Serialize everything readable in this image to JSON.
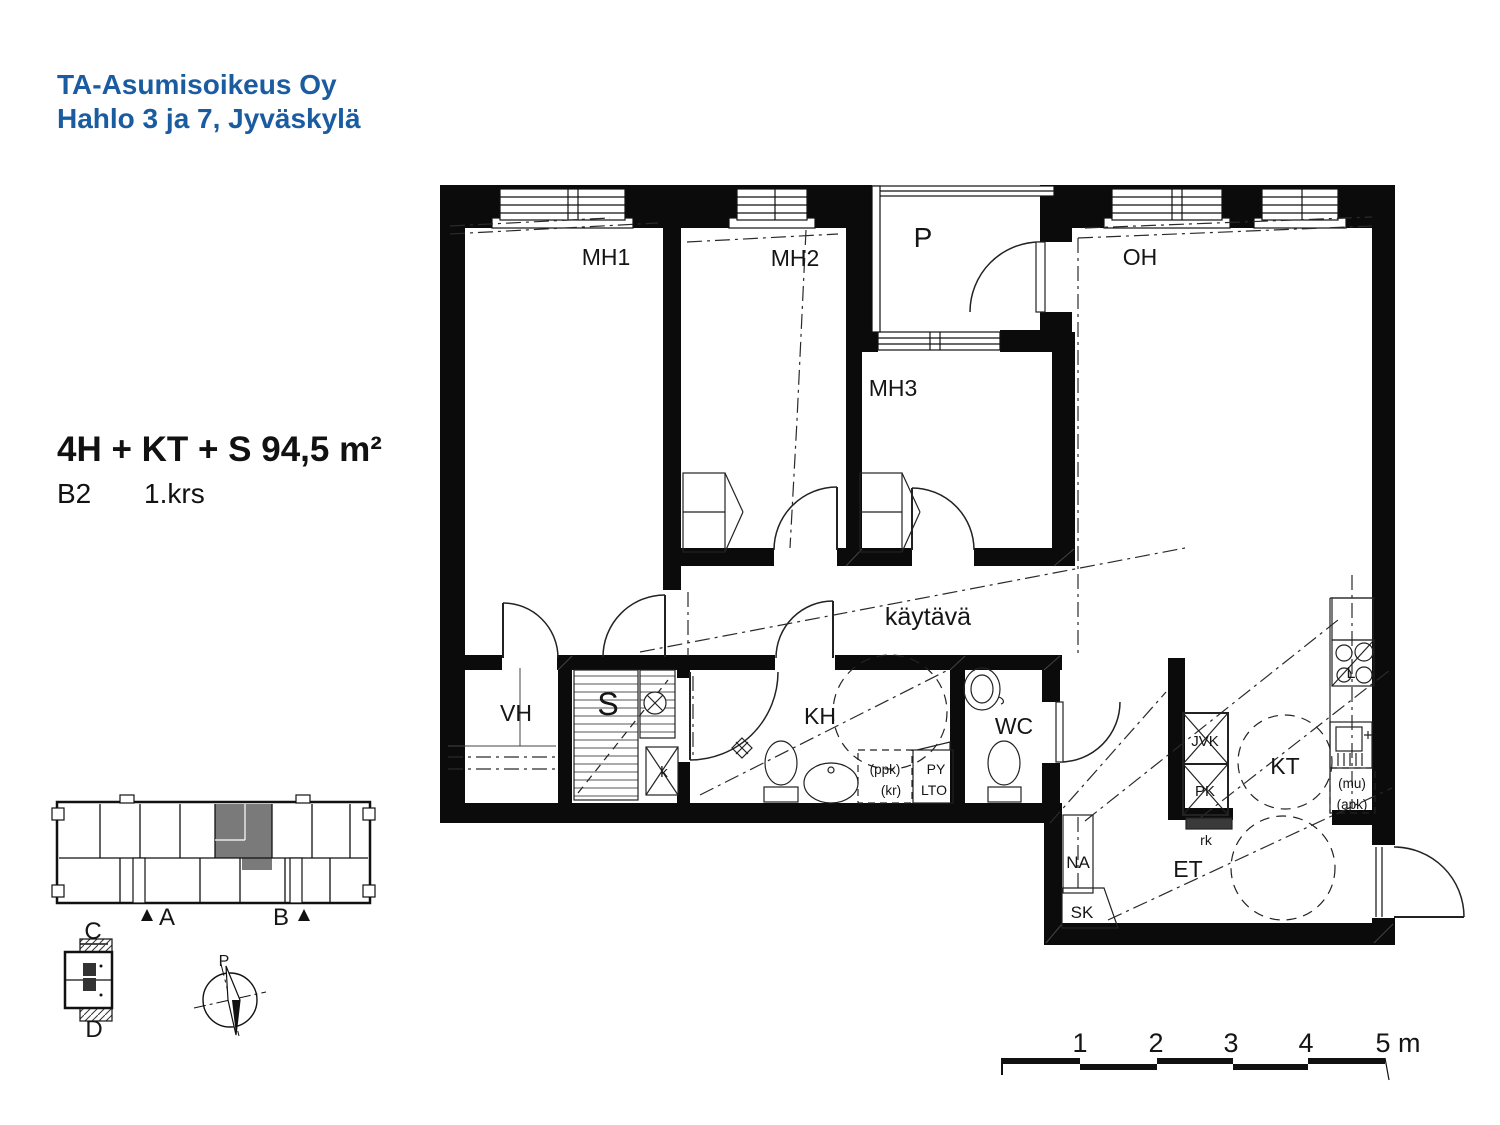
{
  "header": {
    "company": "TA-Asumisoikeus Oy",
    "project": "Hahlo 3 ja 7, Jyväskylä"
  },
  "apartment": {
    "type_area": "4H + KT + S 94,5 m²",
    "unit": "B2",
    "floor": "1.krs"
  },
  "rooms": {
    "mh1": "MH1",
    "mh2": "MH2",
    "mh3": "MH3",
    "oh": "OH",
    "p": "P",
    "kaytava": "käytävä",
    "vh": "VH",
    "s": "S",
    "kh": "KH",
    "wc": "WC",
    "kt": "KT",
    "et": "ET"
  },
  "fixtures": {
    "na": "NA",
    "sk": "SK",
    "jvk": "JVK",
    "pk": "PK",
    "rk": "rk",
    "k": "k",
    "l": "L",
    "ppk": "(ppk)",
    "kr": "(kr)",
    "py": "PY",
    "lto": "LTO",
    "mu": "(mu)",
    "apk": "(apk)"
  },
  "locator": {
    "stair_a": "A",
    "stair_b": "B",
    "stair_c": "C",
    "stair_d": "D",
    "compass_north": "P"
  },
  "scalebar": {
    "m1": "1",
    "m2": "2",
    "m3": "3",
    "m4": "4",
    "m5": "5 m"
  },
  "colors": {
    "accent_blue": "#1b5ca0",
    "highlight_gray": "#7a7a7a"
  }
}
